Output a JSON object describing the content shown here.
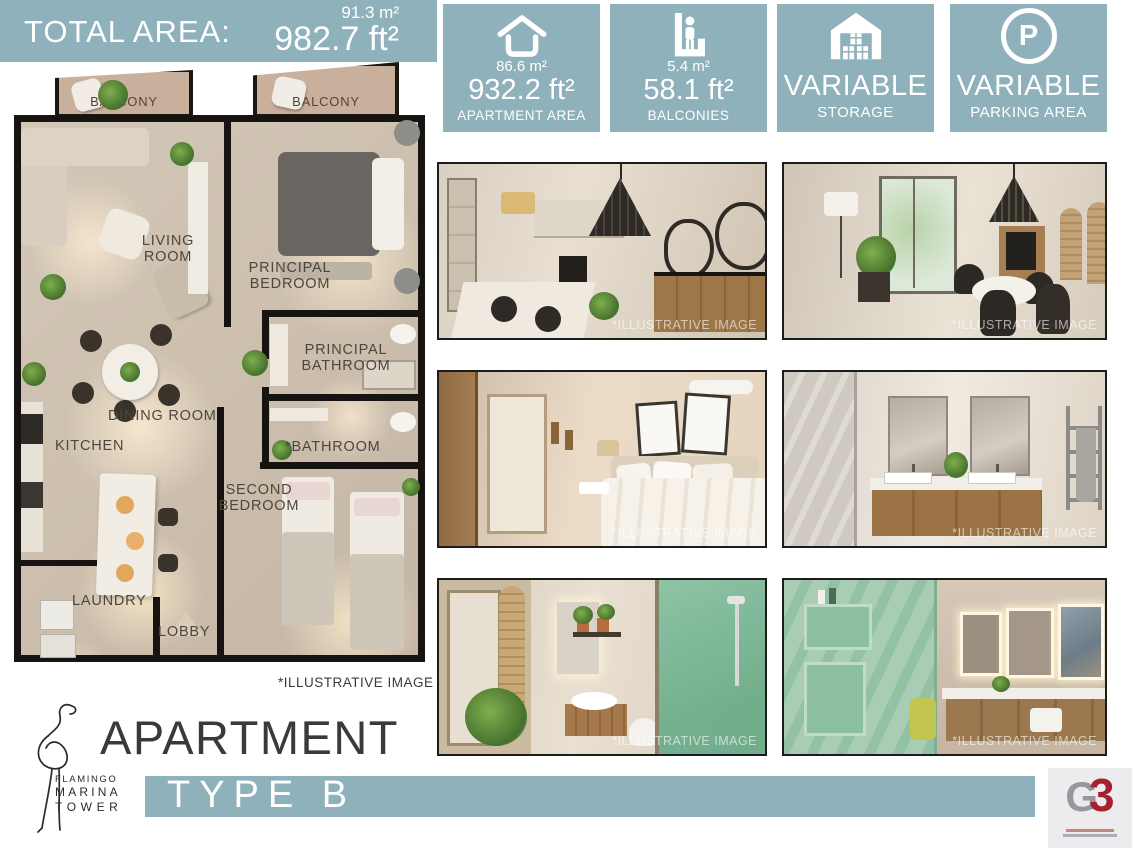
{
  "colors": {
    "teal": "#8fb1bb",
    "dark_text": "#3a3a3a",
    "wall": "#171310",
    "g3_red": "#a6212d",
    "g3_gray": "#97989c"
  },
  "total_area": {
    "label": "TOTAL AREA:",
    "m2": "91.3 m²",
    "ft2": "982.7 ft²"
  },
  "badges": [
    {
      "icon": "house-outline-icon",
      "m2": "86.6 m²",
      "ft2": "932.2 ft²",
      "label": "APARTMENT AREA"
    },
    {
      "icon": "balcony-person-icon",
      "m2": "5.4 m²",
      "ft2": "58.1 ft²",
      "label": "BALCONIES"
    },
    {
      "icon": "storage-boxes-icon",
      "value": "VARIABLE",
      "label": "STORAGE"
    },
    {
      "icon": "parking-icon",
      "icon_letter": "P",
      "value": "VARIABLE",
      "label": "PARKING AREA"
    }
  ],
  "floorplan": {
    "labels": {
      "balcony_left": "BALCONY",
      "balcony_right": "BALCONY",
      "living_1": "LIVING",
      "living_2": "ROOM",
      "principal_bedroom_1": "PRINCIPAL",
      "principal_bedroom_2": "BEDROOM",
      "principal_bathroom_1": "PRINCIPAL",
      "principal_bathroom_2": "BATHROOM",
      "dining": "DINING ROOM",
      "kitchen": "KITCHEN",
      "bathroom": "*BATHROOM",
      "second_bedroom_1": "SECOND",
      "second_bedroom_2": "BEDROOM",
      "laundry": "LAUNDRY",
      "lobby": "LOBBY"
    },
    "note": "*ILLUSTRATIVE IMAGE"
  },
  "photos": [
    {
      "name": "kitchen-dining-render",
      "watermark": "*ILLUSTRATIVE IMAGE"
    },
    {
      "name": "living-room-render",
      "watermark": "*ILLUSTRATIVE IMAGE"
    },
    {
      "name": "bedroom-render",
      "watermark": "*ILLUSTRATIVE IMAGE"
    },
    {
      "name": "double-vanity-bathroom-render",
      "watermark": "*ILLUSTRATIVE IMAGE"
    },
    {
      "name": "shower-bathroom-render",
      "watermark": "*ILLUSTRATIVE IMAGE"
    },
    {
      "name": "green-marble-bathroom-render",
      "watermark": "*ILLUSTRATIVE IMAGE"
    }
  ],
  "footer": {
    "brand_line1": "FLAMINGO",
    "brand_line2": "MARINA",
    "brand_line3": "TOWER",
    "title": "APARTMENT",
    "subtitle": "TYPE B",
    "g3_g": "G",
    "g3_3": "3"
  }
}
